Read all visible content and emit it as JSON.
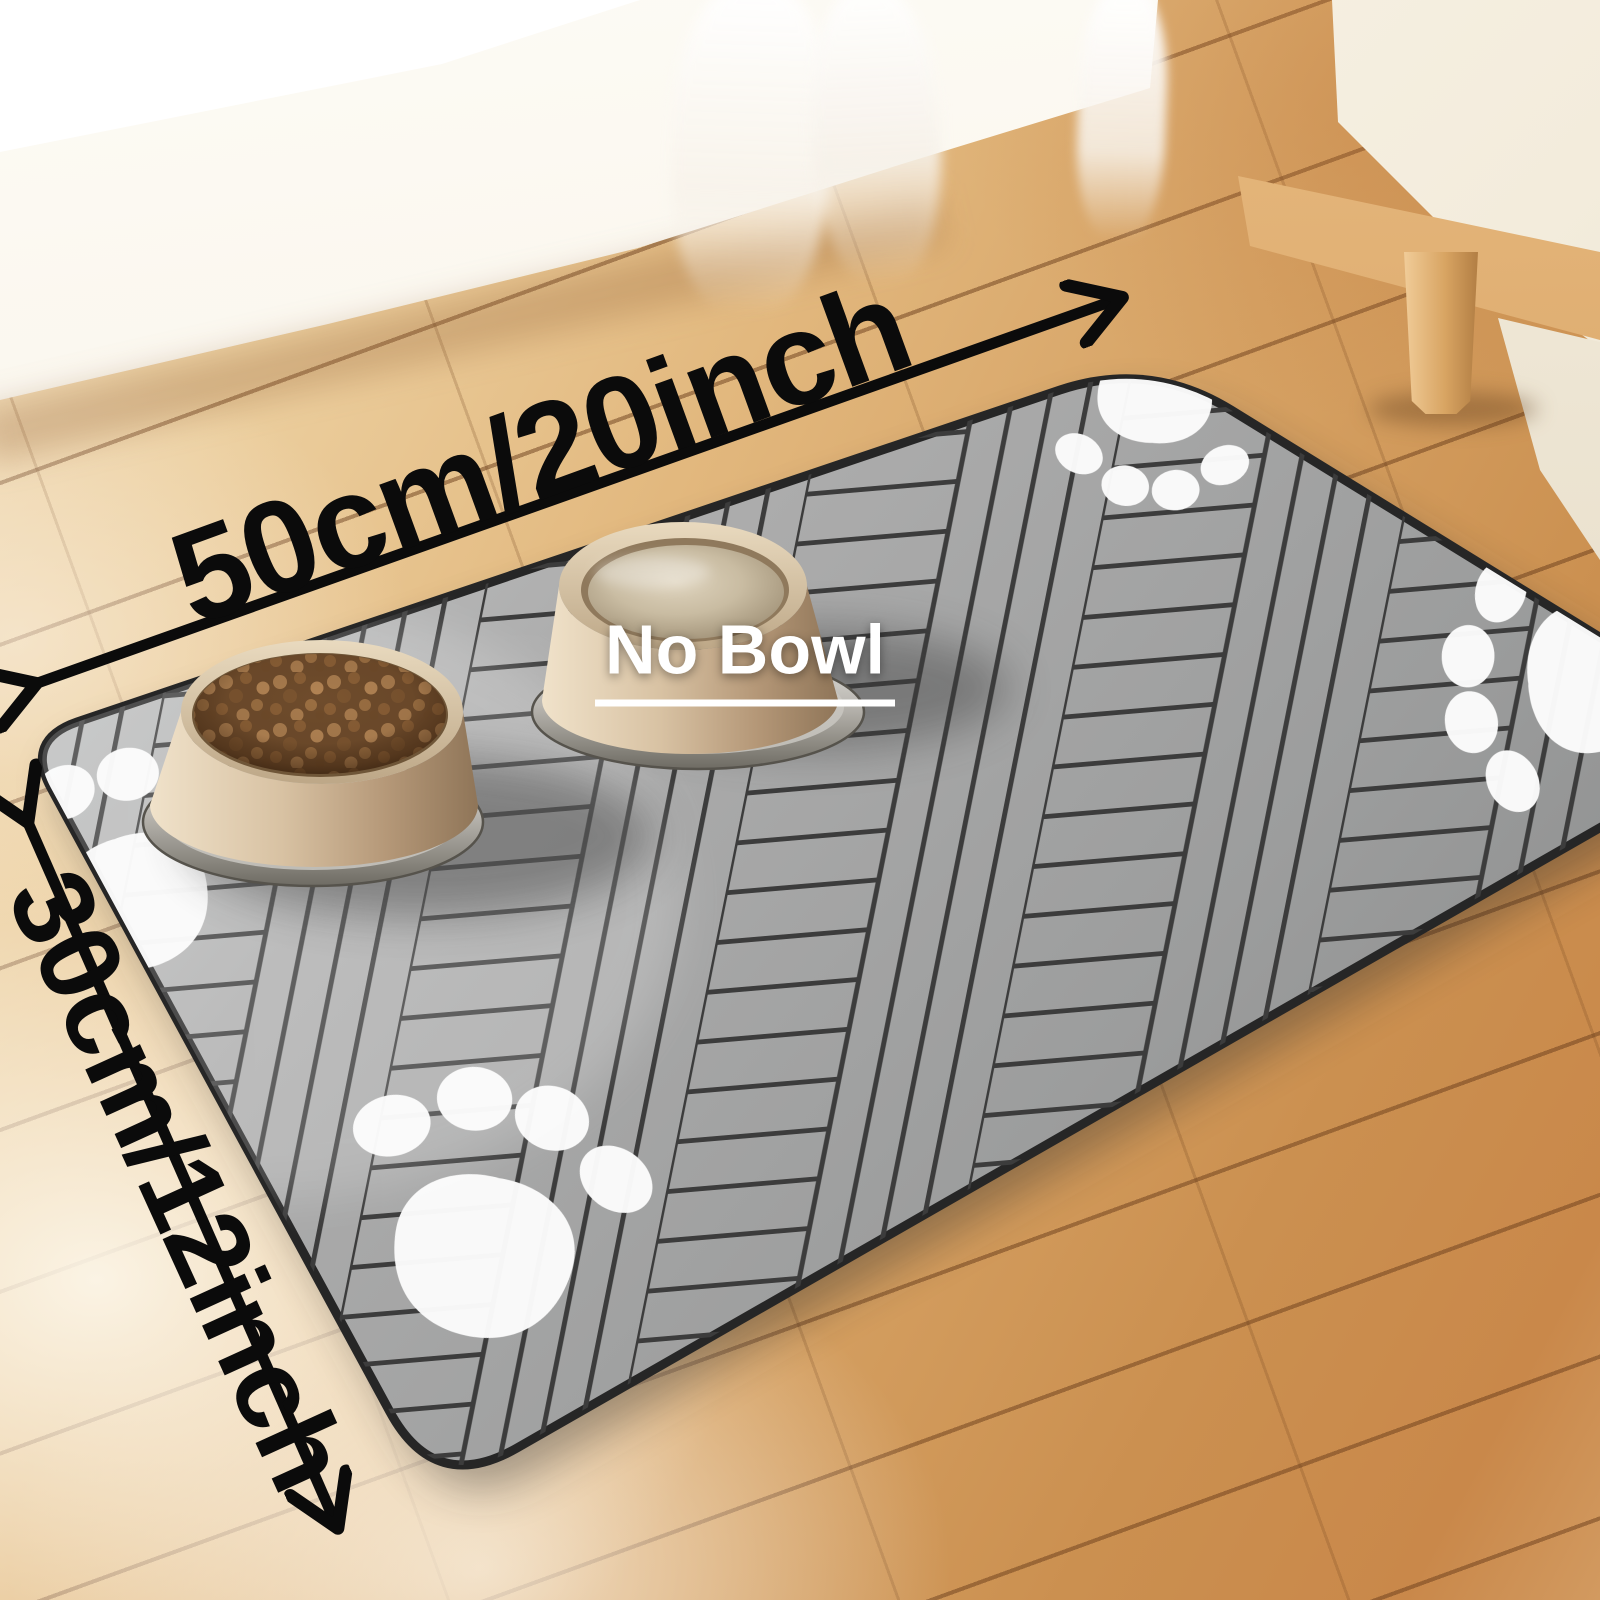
{
  "annotations": {
    "width_label": "50cm/20inch",
    "height_label": "30cm/12inch",
    "no_bowl_label": "No Bowl"
  },
  "palette": {
    "mat_gray": "#a6a7a7",
    "mat_seam_dark": "#3c3c3c",
    "mat_edge_dark": "#262626",
    "paw_white": "#fcfcfc",
    "arrow_black": "#0b0b0b",
    "wood_light": "#f1ddbc",
    "wood_mid": "#d6a264",
    "wall_cream": "#f8f2e6",
    "bowl_tan": "#d6c1a4",
    "bowl_base_silver": "#b9b6b0",
    "kibble_brown": "#9a6f42"
  },
  "icons": {
    "paw_print": "paw-print-icon",
    "dimension_arrow": "double-headed-arrow-icon"
  },
  "objects": {
    "mat": "gray herringbone pet feeding mat",
    "food_bowl": "tan pet bowl filled with kibble",
    "water_bowl": "tan pet bowl filled with water",
    "paw_print_count": 4
  }
}
